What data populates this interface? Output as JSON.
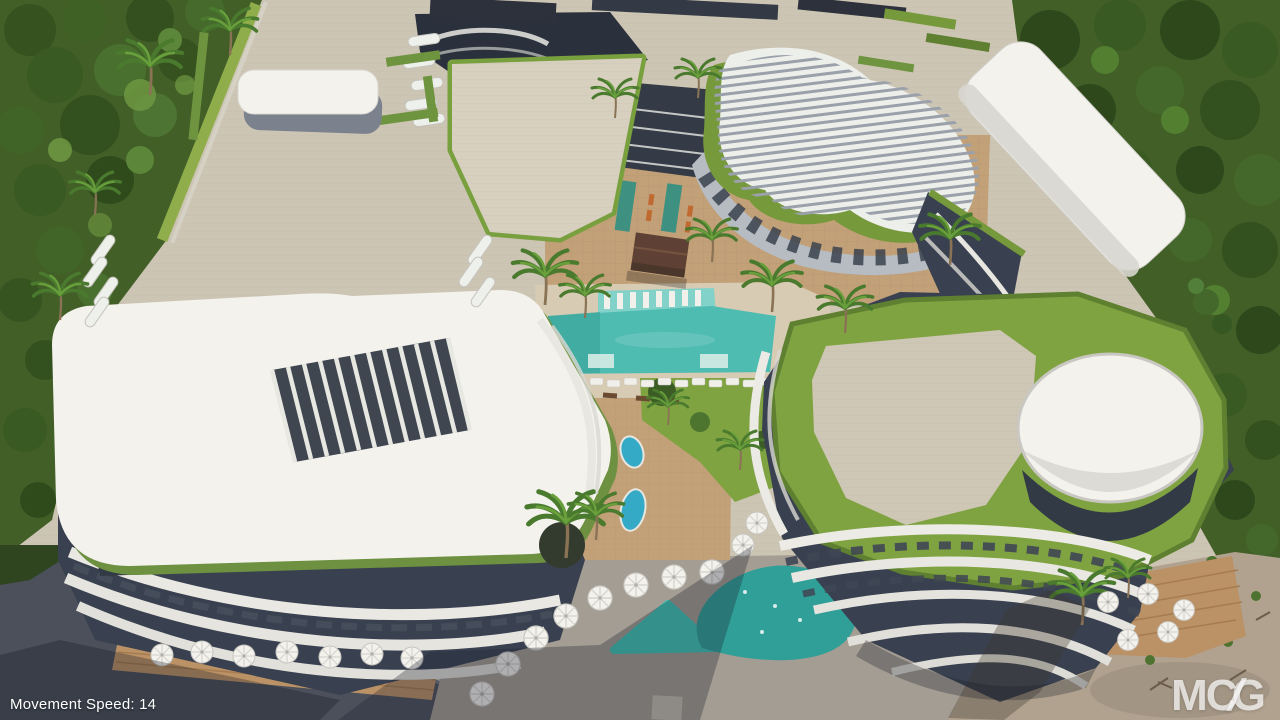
{
  "overlay": {
    "movement_speed": "Movement Speed: 14"
  },
  "watermark": {
    "part1": "MC",
    "separator": "/",
    "part2": "G"
  },
  "colors": {
    "plaza_paving": "#cdc5b4",
    "forest_green": "#415f27",
    "grass_green": "#80a342",
    "roof_green_edge": "#76993c",
    "roof_white": "#f3f2ed",
    "facade_dark": "#394150",
    "facade_light": "#b7bcc2",
    "terracotta_paving": "#c2a078",
    "pool_deck": "#d8cbb4",
    "paving_grey": "#a49d93",
    "road_asphalt": "#4b505b",
    "sand_ground": "#b1a28f",
    "deck_wood": "#bb9166",
    "pool_main": "#4fbcb2",
    "pool_shelf": "#83d2c9",
    "pool_lap": "#3e9180",
    "pool_plunge": "#35aac6",
    "pool_triangle": "#3fc4b6",
    "pool_freeform": "#2f9f97",
    "cabana_brown": "#5e4134",
    "umbrella_white": "#f3f2ed",
    "hud_text": "#ffffff"
  }
}
